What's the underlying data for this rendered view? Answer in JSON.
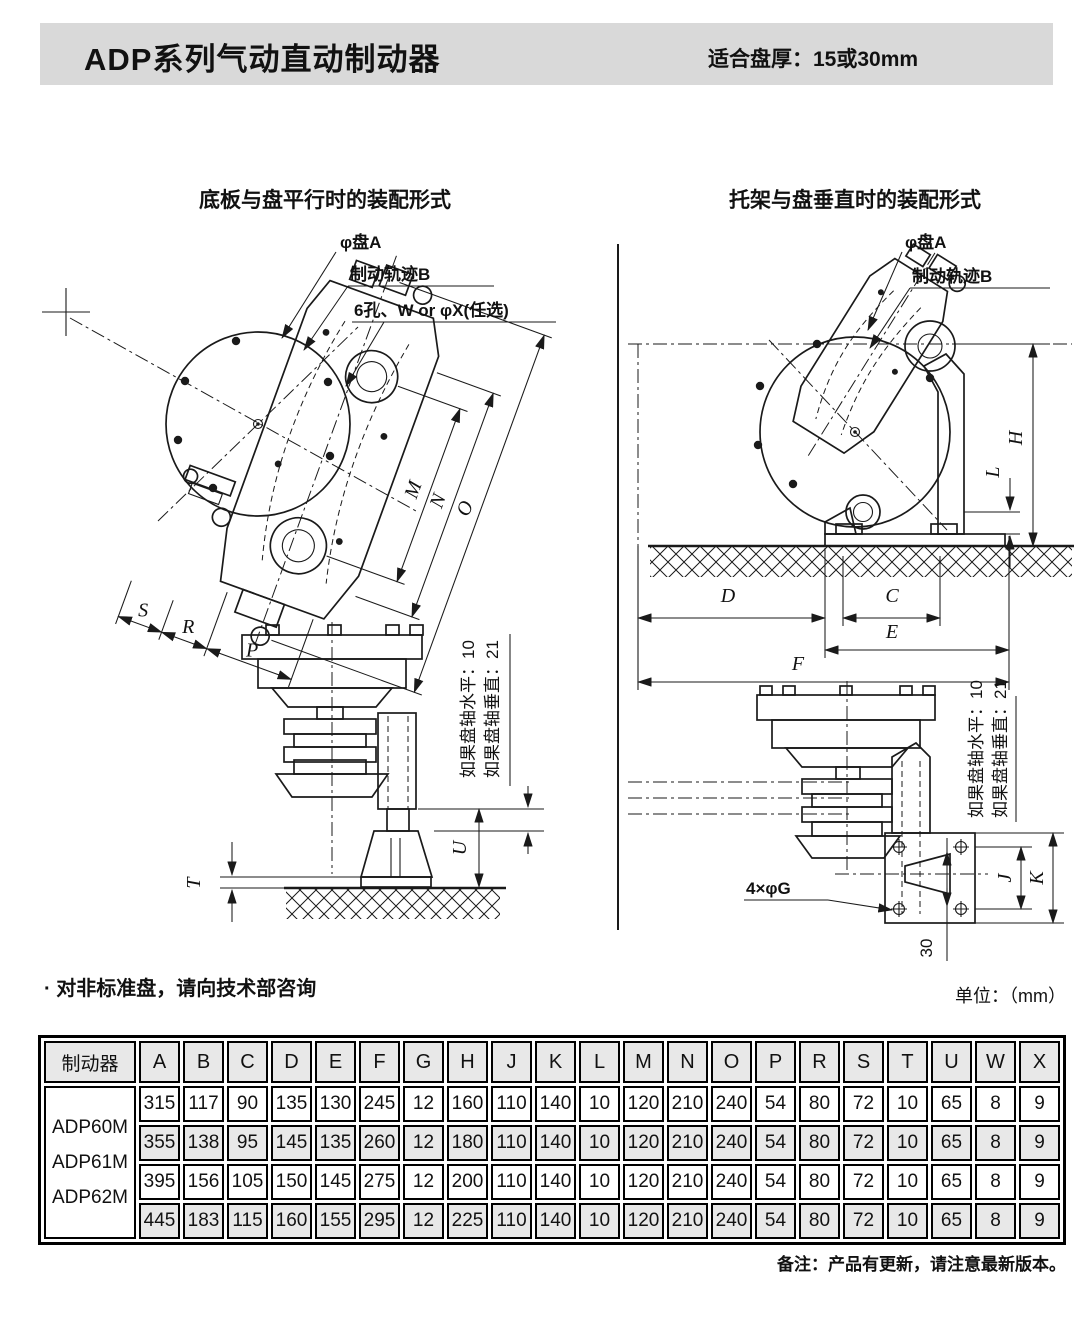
{
  "header": {
    "title": "ADP系列气动直动制动器",
    "subtitle": "适合盘厚：15或30mm"
  },
  "figures": {
    "left": {
      "title": "底板与盘平行时的装配形式",
      "callouts": {
        "disc_a": "φ盘A",
        "track_b": "制动轨迹B",
        "holes": "6孔、W or φX(任选)"
      },
      "notes": {
        "horizontal": "如果盘轴水平：10",
        "vertical": "如果盘轴垂直：21"
      },
      "dims": {
        "m": "M",
        "n": "N",
        "o": "O",
        "p": "P",
        "r": "R",
        "s": "S",
        "t": "T",
        "u": "U"
      }
    },
    "right": {
      "title": "托架与盘垂直时的装配形式",
      "callouts": {
        "disc_a": "φ盘A",
        "track_b": "制动轨迹B",
        "holes": "4×φG",
        "offset": "30"
      },
      "notes": {
        "horizontal": "如果盘轴水平：10",
        "vertical": "如果盘轴垂直：21"
      },
      "dims": {
        "h": "H",
        "l": "L",
        "d": "D",
        "c": "C",
        "e": "E",
        "f": "F",
        "j": "J",
        "k": "K"
      }
    }
  },
  "notes": {
    "nonstandard": "· 对非标准盘，请向技术部咨询",
    "unit": "单位：（mm）",
    "footer": "备注：产品有更新，请注意最新版本。"
  },
  "table": {
    "row_header": "制动器",
    "models": [
      "ADP60M",
      "ADP61M",
      "ADP62M"
    ],
    "columns": [
      "A",
      "B",
      "C",
      "D",
      "E",
      "F",
      "G",
      "H",
      "J",
      "K",
      "L",
      "M",
      "N",
      "O",
      "P",
      "R",
      "S",
      "T",
      "U",
      "W",
      "X"
    ],
    "rows": [
      [
        315,
        117,
        90,
        135,
        130,
        245,
        12,
        160,
        110,
        140,
        10,
        120,
        210,
        240,
        54,
        80,
        72,
        10,
        65,
        8,
        9
      ],
      [
        355,
        138,
        95,
        145,
        135,
        260,
        12,
        180,
        110,
        140,
        10,
        120,
        210,
        240,
        54,
        80,
        72,
        10,
        65,
        8,
        9
      ],
      [
        395,
        156,
        105,
        150,
        145,
        275,
        12,
        200,
        110,
        140,
        10,
        120,
        210,
        240,
        54,
        80,
        72,
        10,
        65,
        8,
        9
      ],
      [
        445,
        183,
        115,
        160,
        155,
        295,
        12,
        225,
        110,
        140,
        10,
        120,
        210,
        240,
        54,
        80,
        72,
        10,
        65,
        8,
        9
      ]
    ]
  }
}
